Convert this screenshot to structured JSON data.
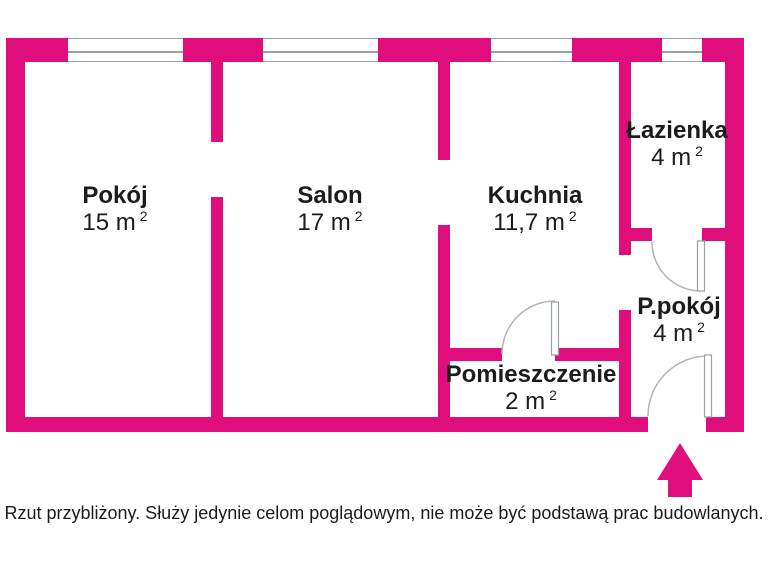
{
  "colors": {
    "wall_pink": "#e00d7d",
    "detail_gray": "#9aa0a6",
    "text_dark": "#1c1c1c"
  },
  "rooms": [
    {
      "name": "Pokój",
      "area": "15",
      "unit": "m",
      "sup": "2"
    },
    {
      "name": "Salon",
      "area": "17",
      "unit": "m",
      "sup": "2"
    },
    {
      "name": "Kuchnia",
      "area": "11,7",
      "unit": "m",
      "sup": "2"
    },
    {
      "name": "Łazienka",
      "area": "4",
      "unit": "m",
      "sup": "2"
    },
    {
      "name": "P.pokój",
      "area": "4",
      "unit": "m",
      "sup": "2"
    },
    {
      "name": "Pomieszczenie",
      "area": "2",
      "unit": "m",
      "sup": "2"
    }
  ],
  "footer": {
    "disclaimer": "Rzut przybliżony. Służy jedynie celom poglądowym, nie może być podstawą prac budowlanych."
  }
}
